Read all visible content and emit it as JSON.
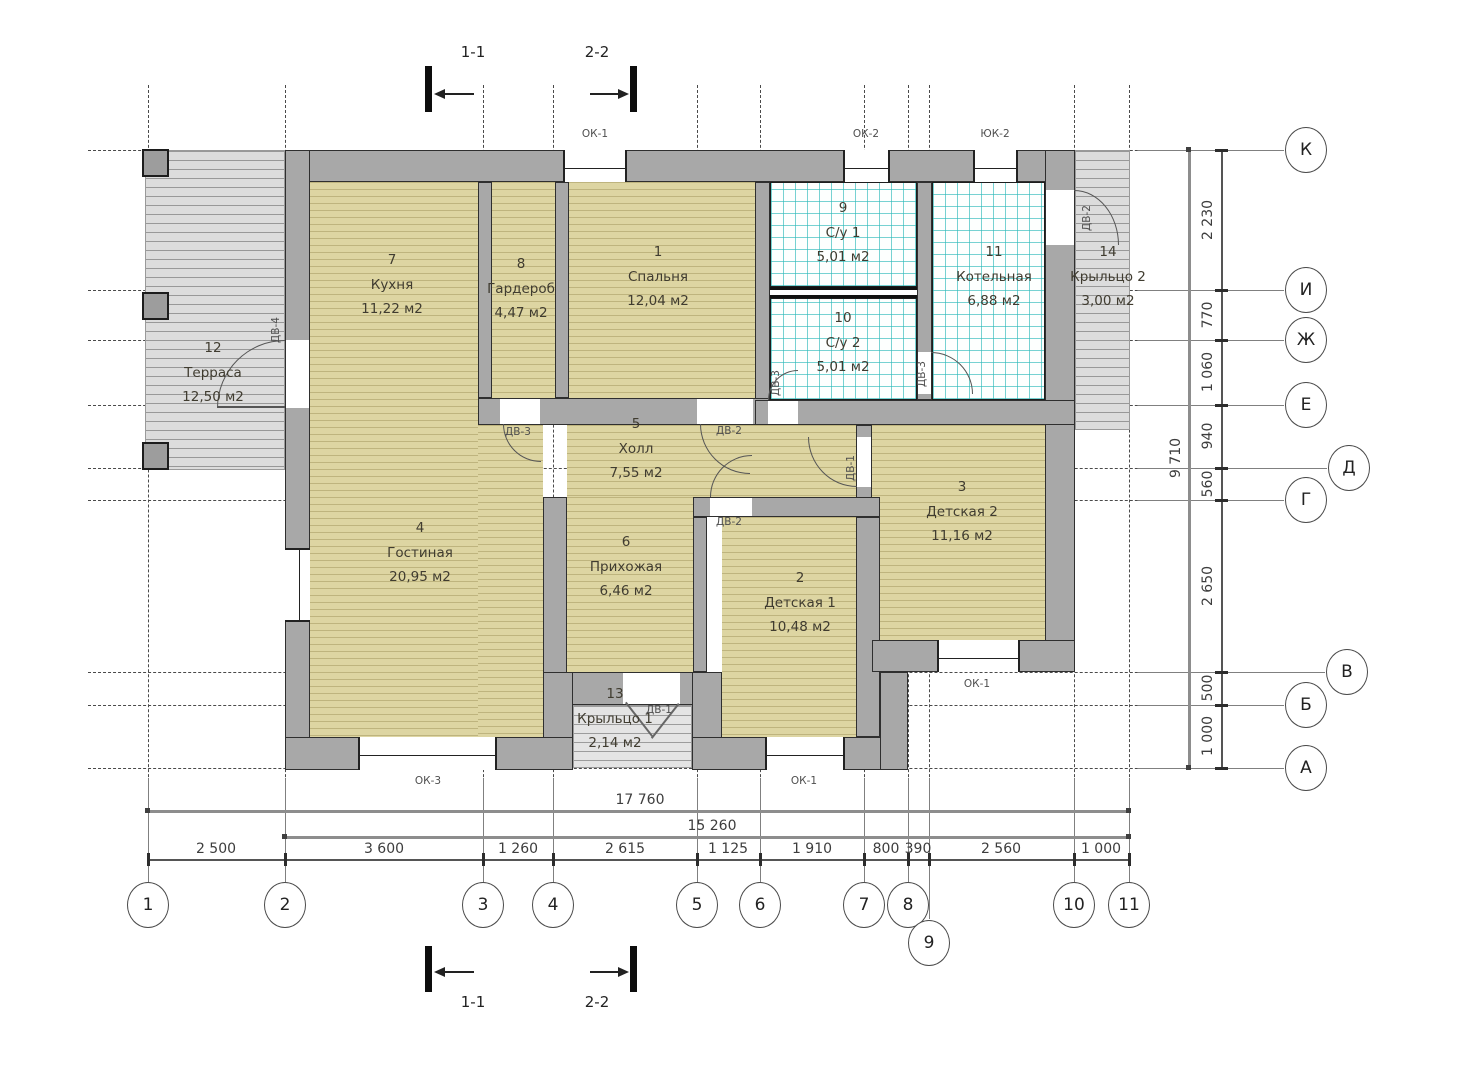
{
  "rooms": [
    {
      "num": "1",
      "name": "Спальня",
      "area": "12,04 м2"
    },
    {
      "num": "2",
      "name": "Детская 1",
      "area": "10,48 м2"
    },
    {
      "num": "3",
      "name": "Детская 2",
      "area": "11,16 м2"
    },
    {
      "num": "4",
      "name": "Гостиная",
      "area": "20,95 м2"
    },
    {
      "num": "5",
      "name": "Холл",
      "area": "7,55 м2"
    },
    {
      "num": "6",
      "name": "Прихожая",
      "area": "6,46 м2"
    },
    {
      "num": "7",
      "name": "Кухня",
      "area": "11,22 м2"
    },
    {
      "num": "8",
      "name": "Гардероб",
      "area": "4,47 м2"
    },
    {
      "num": "9",
      "name": "С/у 1",
      "area": "5,01 м2"
    },
    {
      "num": "10",
      "name": "С/у 2",
      "area": "5,01 м2"
    },
    {
      "num": "11",
      "name": "Котельная",
      "area": "6,88 м2"
    },
    {
      "num": "12",
      "name": "Терраса",
      "area": "12,50 м2"
    },
    {
      "num": "13",
      "name": "Крыльцо 1",
      "area": "2,14 м2"
    },
    {
      "num": "14",
      "name": "Крыльцо 2",
      "area": "3,00 м2"
    }
  ],
  "window_labels": {
    "top1": "ОК-1",
    "top2": "ОК-2",
    "top3": "ЮК-2",
    "bottom_left": "ОК-3",
    "bottom_right": "ОК-1",
    "right": "ОК-1"
  },
  "door_labels": {
    "terrace": "ДВ-4",
    "wardrobe": "ДВ-3",
    "bedroom": "ДВ-2",
    "su2": "ДВ-3",
    "boiler": "ДВ-3",
    "child2": "ДВ-1",
    "child1": "ДВ-2",
    "entry": "ДВ-1",
    "porch2": "ДВ-2"
  },
  "dims": {
    "total_bottom": "17 760",
    "sub_bottom": "15 260",
    "bottom": [
      "2 500",
      "3 600",
      "1 260",
      "2 615",
      "1 125",
      "1 910",
      "800",
      "390",
      "2 560",
      "1 000"
    ],
    "total_right": "9 710",
    "right": [
      "2 230",
      "770",
      "1 060",
      "940",
      "560",
      "2 650",
      "500",
      "1 000"
    ]
  },
  "axes": {
    "numbers": [
      "1",
      "2",
      "3",
      "4",
      "5",
      "6",
      "7",
      "8",
      "9",
      "10",
      "11"
    ],
    "letters": [
      "К",
      "И",
      "Ж",
      "Е",
      "Д",
      "Г",
      "В",
      "Б",
      "А"
    ]
  },
  "sections": {
    "one": "1-1",
    "two": "2-2"
  },
  "colors": {
    "wood_floor": "#ddd5a2",
    "tile_line": "#2fbaba",
    "wall": "#a8a8a8",
    "deck": "#dcdcdc"
  }
}
